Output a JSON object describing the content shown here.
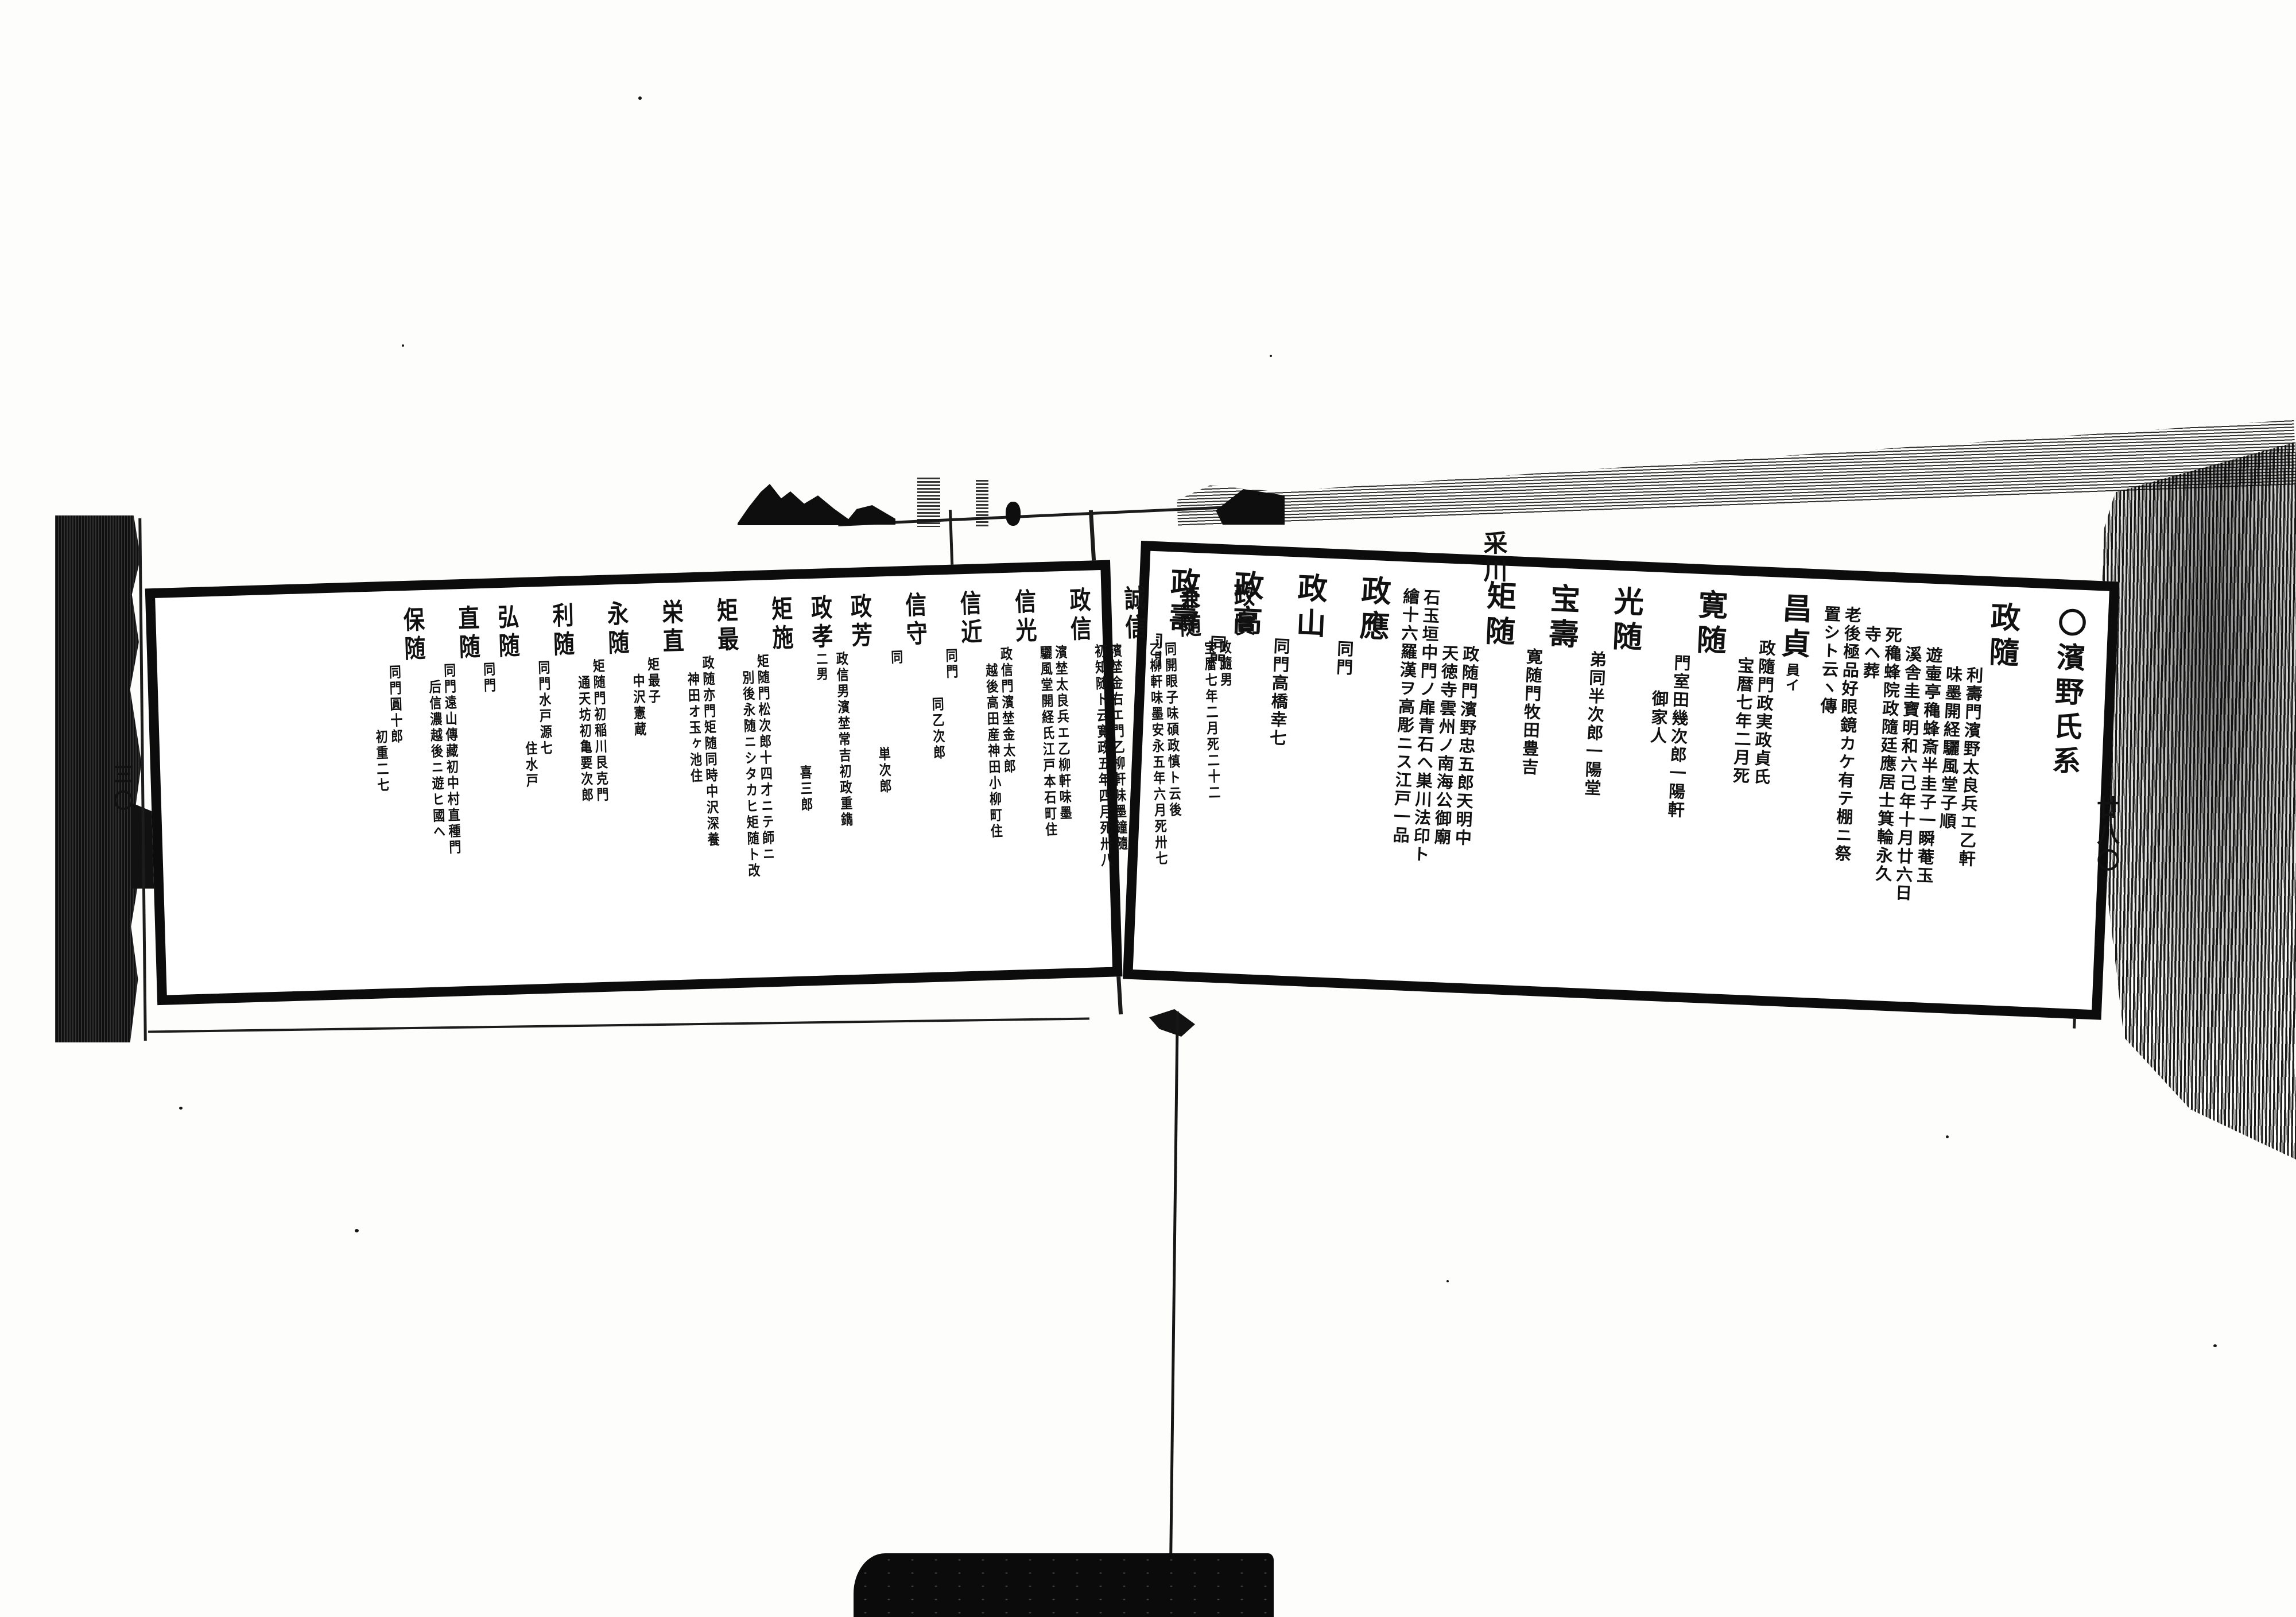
{
  "colors": {
    "ink": "#111111",
    "paper": "#ffffff"
  },
  "marks": {
    "top_margin": "采川",
    "right_folio": "廿八〇",
    "left_folio": "三〇"
  },
  "right_page": {
    "title": "〇濱野氏系",
    "entries": [
      {
        "name": "政隨",
        "notes": [
          {
            "text": "利壽門濱野太良兵エ乙軒",
            "drop": 0
          },
          {
            "text": "味墨開経驪風堂子順",
            "drop": 0
          },
          {
            "text": "遊壷亭穐蜂斎半圭子一瞬菴玉",
            "drop": -1
          },
          {
            "text": "溪舎圭寶明和六己年十月廿六日",
            "drop": -1
          },
          {
            "text": "死穐蜂院政隨廷應居士箕輪永久",
            "drop": -2
          },
          {
            "text": "寺ヘ葬",
            "drop": -2
          },
          {
            "text": "老後極品好眼鏡カケ有テ棚ニ祭",
            "drop": -3
          },
          {
            "text": "置シト云ヽ傳",
            "drop": -3
          }
        ]
      },
      {
        "name": "昌貞",
        "ruby": "員イ",
        "notes": [
          {
            "text": "政隨門政実政貞氏",
            "drop": -1
          },
          {
            "text": "宝暦七年二月死",
            "drop": 0
          }
        ]
      },
      {
        "name": "寛随",
        "notes": [
          {
            "text": "門室田幾次郎一陽軒",
            "drop": 0
          },
          {
            "text": "御家人",
            "drop": 2
          }
        ]
      },
      {
        "name": "光随",
        "notes": [
          {
            "text": "弟同半次郎一陽堂",
            "drop": 0
          }
        ]
      },
      {
        "name": "宝壽",
        "notes": [
          {
            "text": "寛随門牧田豊吉",
            "drop": 0
          }
        ]
      },
      {
        "name": "矩随",
        "notes": [
          {
            "text": "政随門濱野忠五郎天明中",
            "drop": 0
          },
          {
            "text": "天徳寺雲州ノ南海公御廟",
            "drop": 0
          },
          {
            "text": "石玉垣中門ノ扉青石ヘ巣川法印ト",
            "drop": -3
          },
          {
            "text": "繪十六羅漢ヲ高彫ニス江戸一品",
            "drop": -3
          }
        ]
      },
      {
        "name": "政應",
        "notes": [
          {
            "text": "同門",
            "drop": 0
          }
        ]
      },
      {
        "name": "政山",
        "notes": [
          {
            "text": "同門高橋幸七",
            "drop": 0
          }
        ]
      },
      {
        "name": "政高",
        "notes": [
          {
            "text": "同門",
            "drop": 0
          }
        ]
      },
      {
        "name": "政壽",
        "notes": [
          {
            "text": "同門",
            "drop": 0
          }
        ]
      }
    ]
  },
  "left_page": {
    "entries": [
      {
        "name": "政實",
        "notes": [
          {
            "text": "政隨男",
            "drop": 0
          },
          {
            "text": "宝暦七年二月死二十二",
            "drop": 0
          }
        ]
      },
      {
        "name": "兼随",
        "notes": [
          {
            "text": "同開眼子味碩政慎ト云後",
            "drop": 0
          },
          {
            "text": "乙柳軒味墨安永五年六月死卅七",
            "drop": 0
          }
        ]
      },
      {
        "name": "誠信",
        "notes": [
          {
            "text": "濱埜金右エ門乙柳軒味墨鐘隨",
            "drop": 0
          },
          {
            "text": "初知随ト云寛政五年四月死卅八",
            "drop": 0
          }
        ]
      },
      {
        "name": "政信",
        "notes": [
          {
            "text": "濱埜太良兵エ乙柳軒味墨",
            "drop": 0
          },
          {
            "text": "驪風堂開経氏江戸本石町住",
            "drop": 0
          }
        ]
      },
      {
        "name": "信光",
        "notes": [
          {
            "text": "政信門濱埜金太郎",
            "drop": 0
          },
          {
            "text": "越後高田産神田小柳町住",
            "drop": 1
          }
        ]
      },
      {
        "name": "信近",
        "notes": [
          {
            "text": "同門",
            "drop": 0
          },
          {
            "text": "同乙次郎",
            "drop": 3
          }
        ]
      },
      {
        "name": "信守",
        "notes": [
          {
            "text": "同",
            "drop": 0
          },
          {
            "text": "単次郎",
            "drop": 6
          }
        ]
      },
      {
        "name": "政芳",
        "notes": [
          {
            "text": "政信男濱埜常吉初政重鐫",
            "drop": 0
          }
        ]
      },
      {
        "name": "政孝",
        "ruby": "二男",
        "notes": [
          {
            "text": "喜三郎",
            "drop": 7
          }
        ]
      },
      {
        "name": "矩施",
        "notes": [
          {
            "text": "矩随門松次郎十四才ニテ師ニ",
            "drop": 0
          },
          {
            "text": "別後永随ニシタカヒ矩随ト改",
            "drop": 1
          }
        ]
      },
      {
        "name": "矩最",
        "notes": [
          {
            "text": "政随亦門矩随同時中沢深養",
            "drop": 0
          },
          {
            "text": "神田オ玉ヶ池住",
            "drop": 1
          }
        ]
      },
      {
        "name": "栄直",
        "notes": [
          {
            "text": "矩最子",
            "drop": 0
          },
          {
            "text": "中沢憲蔵",
            "drop": 1
          }
        ]
      },
      {
        "name": "永随",
        "notes": [
          {
            "text": "矩随門初稲川艮克門",
            "drop": 0
          },
          {
            "text": "通天坊初亀要次郎",
            "drop": 1
          }
        ]
      },
      {
        "name": "利随",
        "notes": [
          {
            "text": "同門水戸源七",
            "drop": 0
          },
          {
            "text": "住水戸",
            "drop": 5
          }
        ]
      },
      {
        "name": "弘随",
        "notes": [
          {
            "text": "同門",
            "drop": 0
          }
        ]
      },
      {
        "name": "直随",
        "notes": [
          {
            "text": "同門遠山傳藏初中村直種門",
            "drop": 0
          },
          {
            "text": "后信濃越後ニ遊ヒ國ヘ",
            "drop": 1
          }
        ]
      },
      {
        "name": "保随",
        "notes": [
          {
            "text": "同門圓十郎",
            "drop": 0
          },
          {
            "text": "初重二七",
            "drop": 4
          }
        ]
      }
    ]
  }
}
